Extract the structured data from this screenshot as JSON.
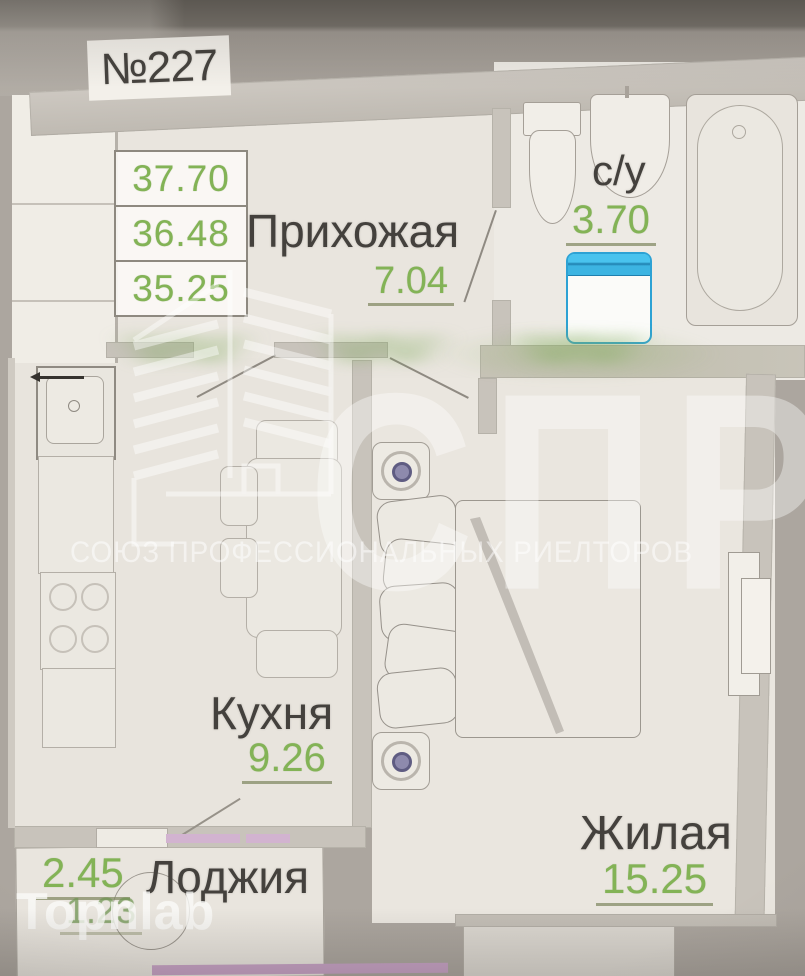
{
  "unit": {
    "number": "№227"
  },
  "area_summary": {
    "values": [
      "37.70",
      "36.48",
      "35.25"
    ]
  },
  "rooms": {
    "hallway": {
      "name": "Прихожая",
      "area": "7.04"
    },
    "bathroom": {
      "name": "с/у",
      "area": "3.70"
    },
    "kitchen": {
      "name": "Кухня",
      "area": "9.26"
    },
    "living": {
      "name": "Жилая",
      "area": "15.25"
    },
    "loggia": {
      "name": "Лоджия",
      "area": "2.45",
      "area_reduced": "1.23"
    }
  },
  "watermarks": {
    "agency_abbr": "СПР",
    "agency_full": "СОЮЗ ПРОФЕССИОНАЛЬНЫХ РИЕЛТОРОВ",
    "crm_brand": "Topnlab",
    "site_text": "www"
  },
  "fixtures": [
    "toilet",
    "sink",
    "bathtub",
    "washing-machine",
    "kitchen-sink",
    "stove",
    "dining-table",
    "chair",
    "bed",
    "wardrobe",
    "stool",
    "window",
    "round-table",
    "door-swing"
  ],
  "colors": {
    "area_green": "#83b356",
    "label_dark": "#44413d",
    "wall_gray": "#c8c3bb",
    "floor_cream": "#e9e5de",
    "bathroom_white": "#edeae4",
    "bg_gray": "#aca69f",
    "machine_blue": "#2da2d4",
    "machine_blue_light": "#49c3ee",
    "accent_pink": "#d2b3d0"
  }
}
